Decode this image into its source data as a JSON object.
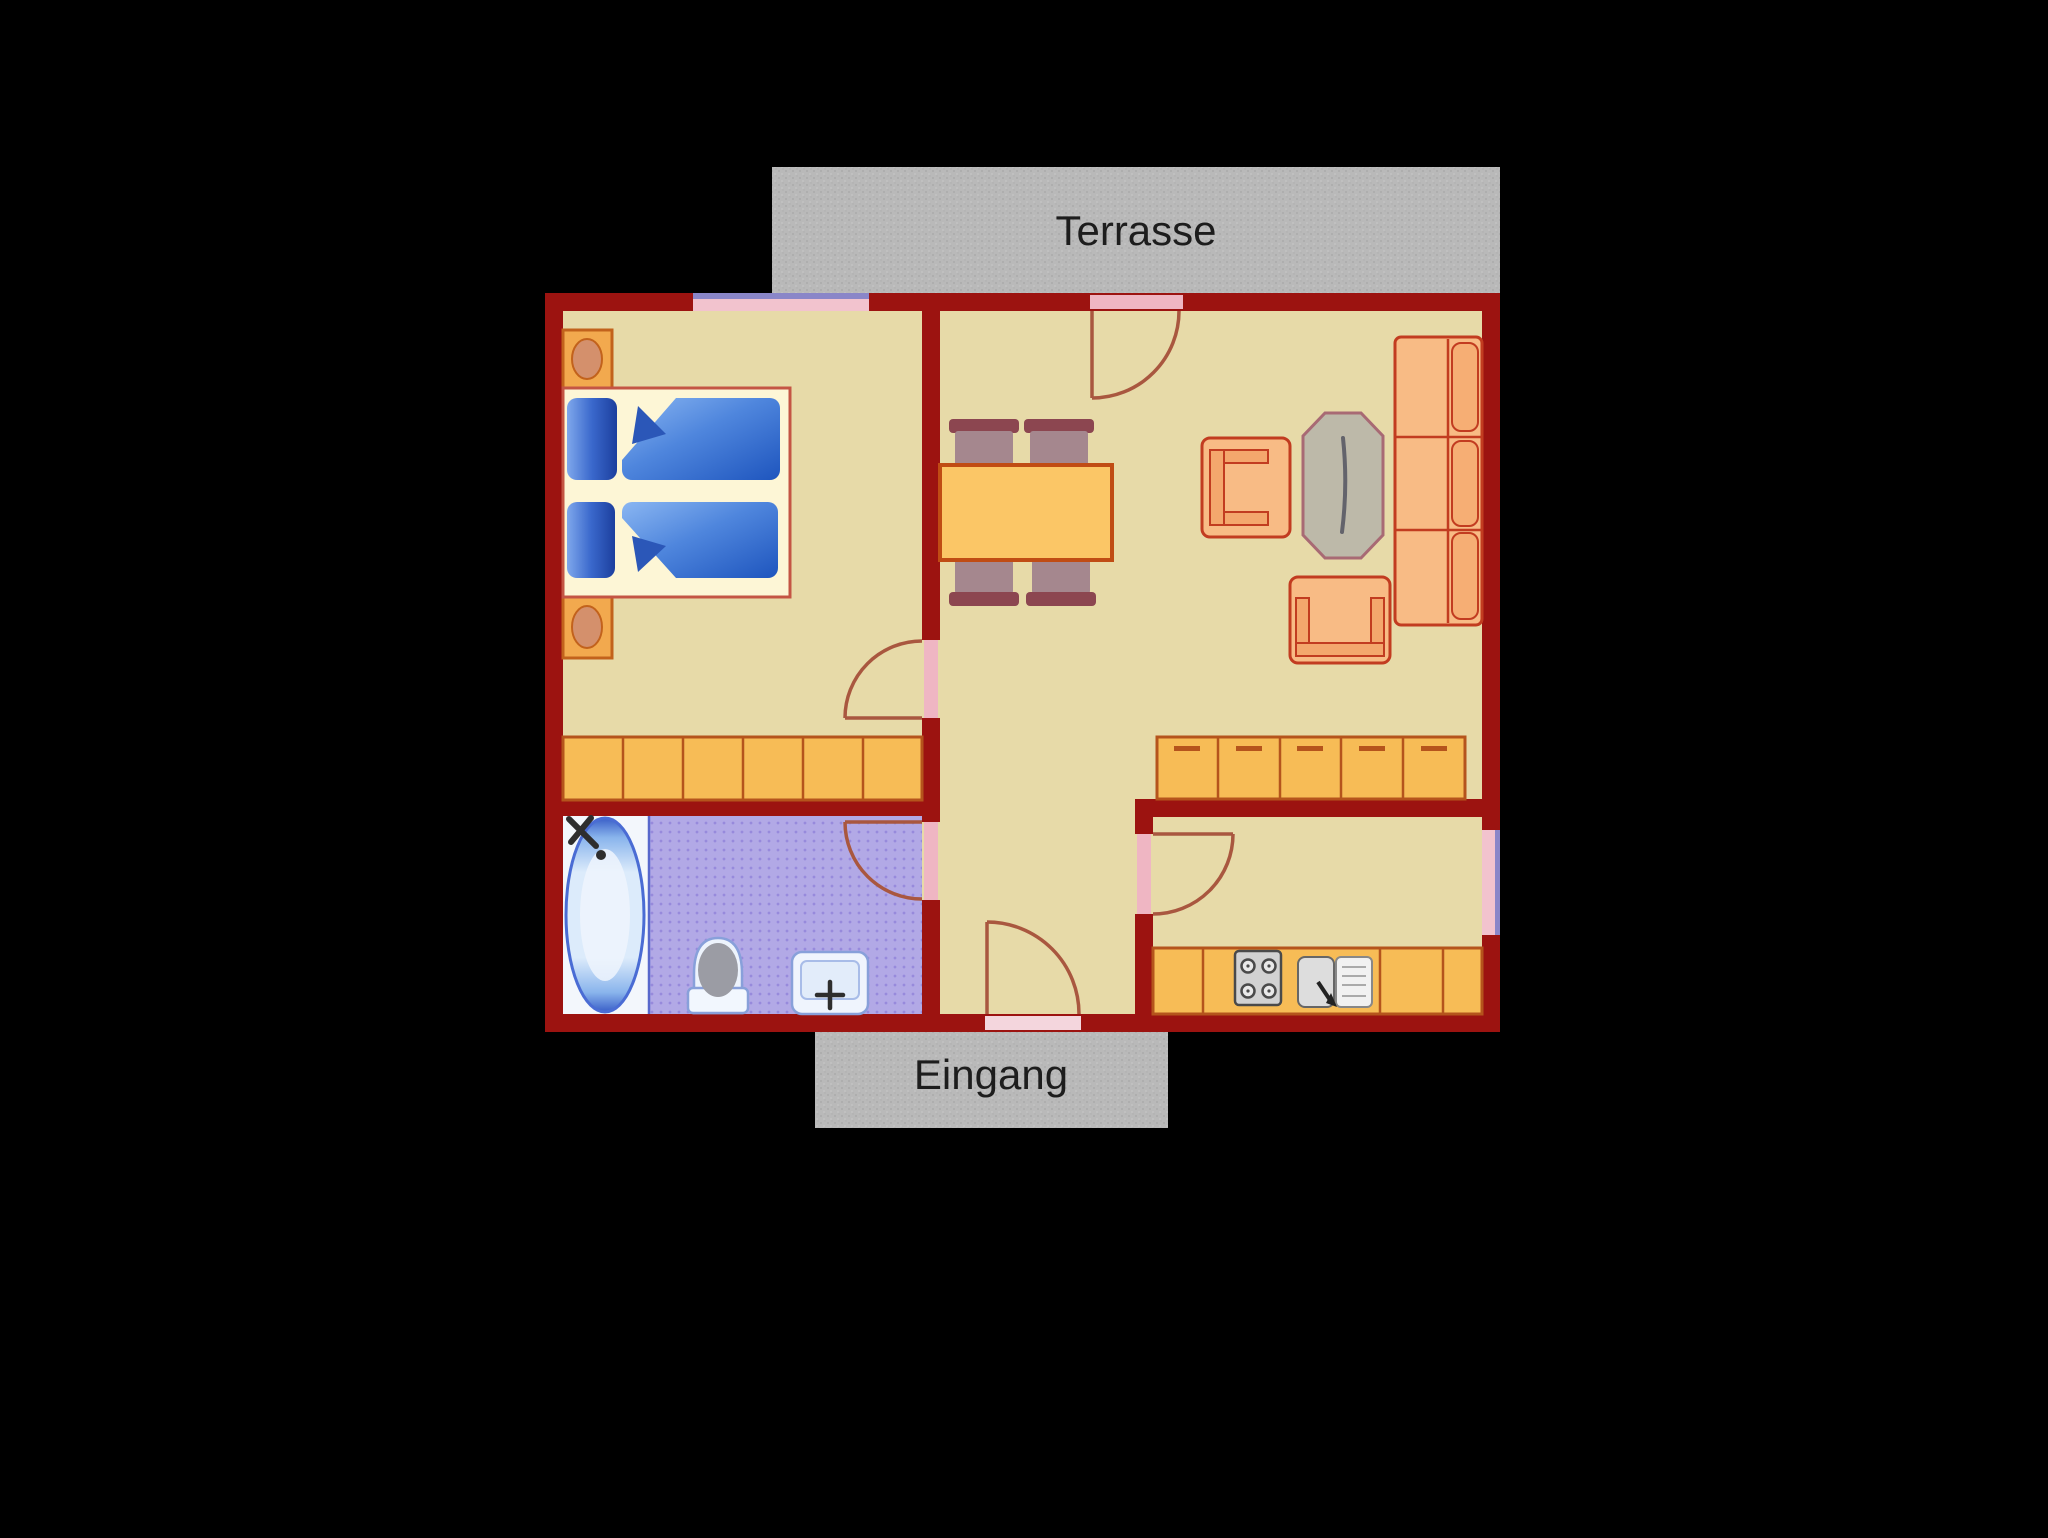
{
  "labels": {
    "terrace": "Terrasse",
    "entrance": "Eingang"
  },
  "colors": {
    "background": "#000000",
    "wall_red": "#9c1310",
    "floor_tan": "#e7daa8",
    "bathroom_floor_lavender": "#b2a9e6",
    "concrete_gray": "#b9b9b9",
    "cabinet_orange": "#f7bc56",
    "table_orange": "#fbc666",
    "upholstery_orange": "#f8bb85",
    "upholstery_accent_red": "#c23c20",
    "mattress_blue": "#2a5fc4",
    "door_leaf_pink": "#efb6c3",
    "window_pink": "#f2c3ce",
    "window_purple": "#8a86c8",
    "label_text": "#1d1d1d"
  },
  "fixtures": [
    "terrace",
    "bedroom",
    "living-dining-area",
    "hallway",
    "bathroom",
    "kitchen",
    "double-bed",
    "nightstand",
    "wardrobe",
    "dining-table",
    "dining-chair",
    "armchair",
    "coffee-table",
    "sofa",
    "sideboard",
    "kitchen-counter",
    "stove",
    "kitchen-sink",
    "bathtub",
    "toilet",
    "washbasin",
    "door",
    "window"
  ]
}
